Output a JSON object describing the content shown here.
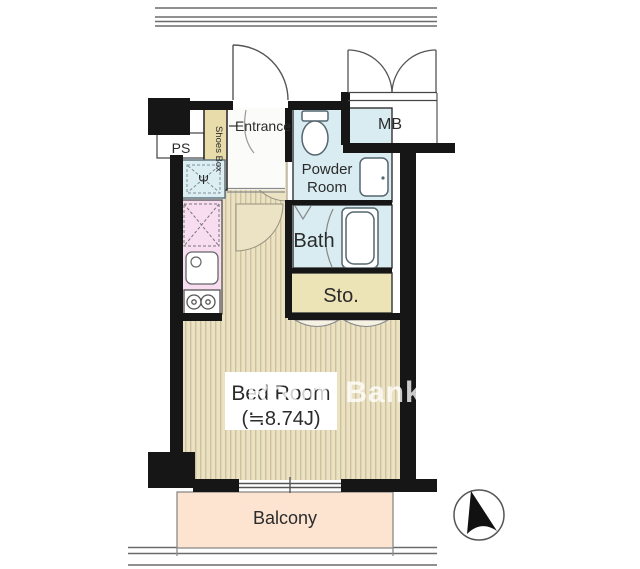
{
  "floorplan": {
    "rooms": {
      "ps": "PS",
      "shoes_box": "Shoes Box",
      "entrance": "Entrance",
      "powder_room_line1": "Powder",
      "powder_room_line2": "Room",
      "mb": "MB",
      "bath": "Bath",
      "storage": "Sto.",
      "bedroom": "Bed Room",
      "bedroom_size": "(≒8.74J)",
      "balcony": "Balcony"
    },
    "washer_symbol": "Ψ",
    "watermark": "Room Bank",
    "colors": {
      "wall": "#161616",
      "floor_base": "#ebe2c3",
      "floor_stripe": "#cdc29c",
      "wet_room": "#d9ecf1",
      "storage_beige": "#ece4b6",
      "shoes_beige": "#e9dcab",
      "kitchen_pink": "#f8dcf0",
      "washer_blue": "#ddeef2",
      "balcony_peach": "#fce4d1",
      "door_swing": "#ece3c4",
      "entrance_white": "#fbfbf9"
    }
  }
}
